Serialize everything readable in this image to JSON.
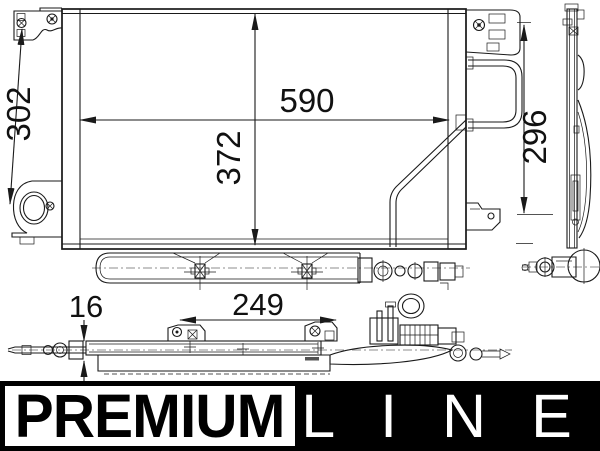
{
  "drawing": {
    "description": "technical drawing of automotive A/C condenser, front view, side view and bottom view",
    "dimensions": {
      "front_width": "590",
      "core_height": "372",
      "left_height": "302",
      "right_height": "296",
      "drier_offset": "249",
      "tube_thickness": "16"
    }
  },
  "logo": {
    "premium": "PREMIUM",
    "line": "LINE"
  },
  "colors": {
    "line_color": "#1a1a1a",
    "background": "#ffffff",
    "logo_black": "#000000",
    "logo_white": "#ffffff"
  }
}
